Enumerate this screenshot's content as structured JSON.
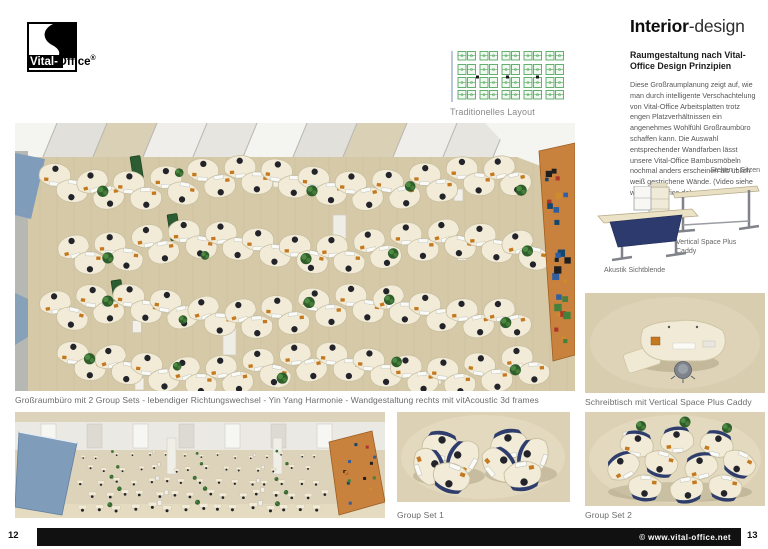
{
  "logo": {
    "name_bold": "Vital-",
    "name_rest": "Office",
    "reg": "®"
  },
  "schematic": {
    "caption": "Traditionelles Layout"
  },
  "article": {
    "title_strong": "Interior",
    "title_light": "-design",
    "heading": "Raumgestaltung nach Vital-Office Design Prinzipien",
    "body": "Diese Großraumplanung zeigt auf, wie man durch intelligente Verschachtelung von Vital-Office Arbeitsplatten trotz engen Platzverhältnissen ein angenehmes Wohlfühl Großraumbüro schaffen kann. Die Auswahl entsprechender Wandfarben lässt unsere Vital-Office Bambusmöbeln nochmal anders erscheinen als üblich weiß gestrichene Wände. (Video siehe www.vital-office.de)"
  },
  "products": {
    "sit_stand_label": "Stehen + Sitzen",
    "caddy_caption": "Vertical Space Plus Caddy",
    "acoustic_caption": "Akustik Sichtblende",
    "desk_topview_caption": "Schreibtisch mit Vertical Space Plus Caddy"
  },
  "main_render": {
    "caption": "Großraumbüro mit 2 Group Sets - lebendiger Richtungswechsel - Yin Yang Harmonie - Wandgestaltung rechts mit vitAcoustic 3d frames"
  },
  "group_sets": {
    "set1_caption": "Group Set 1",
    "set2_caption": "Group Set 2"
  },
  "footer": {
    "page_left": "12",
    "page_right": "13",
    "copyright": "© www.vital-office.net"
  },
  "colors": {
    "floor_beige": "#d6c9a8",
    "desk_cream": "#f1ebd8",
    "accent_orange_wall": "#c9813e",
    "wall_blue": "#7f9cba",
    "schematic_green": "#3f9e4b",
    "panel_green": "#2c5c31",
    "footer_black": "#111111",
    "caption_gray": "#6b6b6b"
  }
}
